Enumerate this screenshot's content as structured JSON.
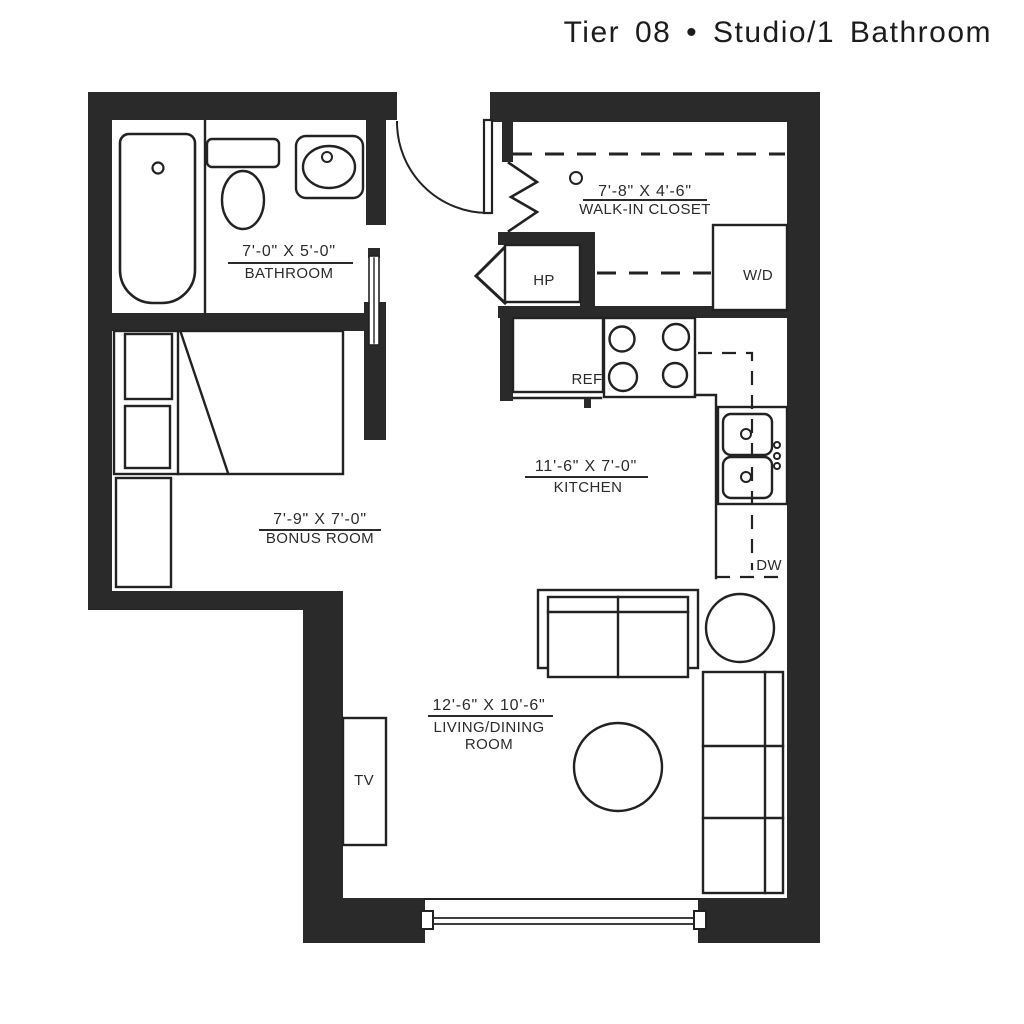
{
  "title": "Tier 08 • Studio/1 Bathroom",
  "rooms": {
    "bathroom": {
      "dims": "7'-0\" X 5'-0\"",
      "name": "BATHROOM"
    },
    "walk_in_closet": {
      "dims": "7'-8\" X 4'-6\"",
      "name": "WALK-IN CLOSET"
    },
    "kitchen": {
      "dims": "11'-6\" X 7'-0\"",
      "name": "KITCHEN"
    },
    "bonus_room": {
      "dims": "7'-9\" X 7'-0\"",
      "name": "BONUS ROOM"
    },
    "living_dining_room": {
      "dims": "12'-6\" X 10'-6\"",
      "name_line1": "LIVING/DINING",
      "name_line2": "ROOM"
    }
  },
  "labels": {
    "heat_pump": "HP",
    "washer_dryer": "W/D",
    "refrigerator": "REF",
    "dishwasher": "DW",
    "tv": "TV"
  },
  "colors": {
    "wall": "#2a2a2a",
    "line": "#222222",
    "text": "#2b2b2b",
    "paper": "#ffffff"
  }
}
